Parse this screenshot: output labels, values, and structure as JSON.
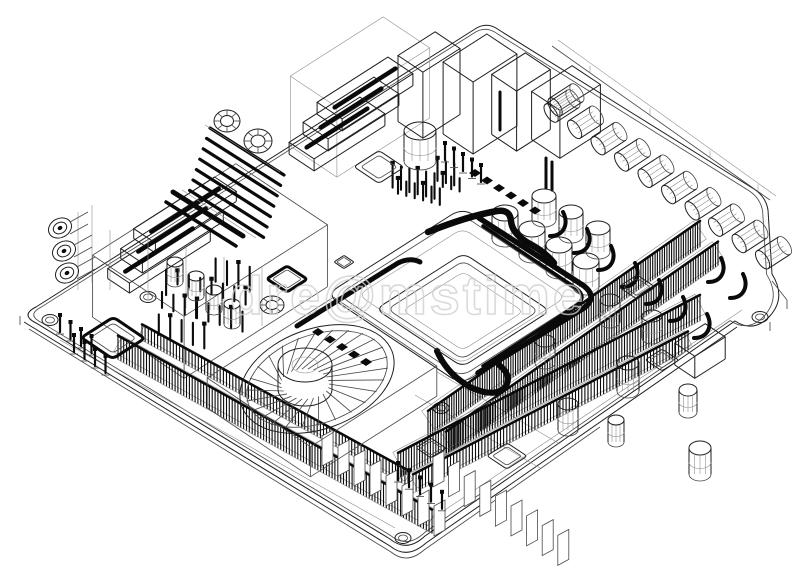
{
  "image": {
    "kind": "3d-wireframe-blueprint",
    "subject": "computer motherboard architect blueprint, isometric wireframe drawing",
    "background": "#ffffff",
    "width_px": 800,
    "height_px": 566
  },
  "watermark": {
    "text": "dre@mstime",
    "color": "#d0d0d0",
    "opacity": 0.78
  },
  "palette": {
    "line": "#1f1f1f",
    "soft": "#4a4a4a",
    "faint": "#8f8f8f",
    "dark": "#0a0a0a",
    "white": "#ffffff"
  },
  "components": [
    "pcb-board",
    "mounting-holes",
    "cpu-socket",
    "cpu-die",
    "heat-pipe",
    "cooling-fan",
    "dimm-memory-slots",
    "expansion-slots",
    "slot-pillars",
    "capacitor-row",
    "capacitor-grid",
    "capacitor-cluster",
    "io-port-stack",
    "left-io-shroud",
    "audio-jacks",
    "heatsink-fins",
    "toroid-coils",
    "chips",
    "pin-headers",
    "rear-io-wall",
    "standoff-cylinders"
  ]
}
